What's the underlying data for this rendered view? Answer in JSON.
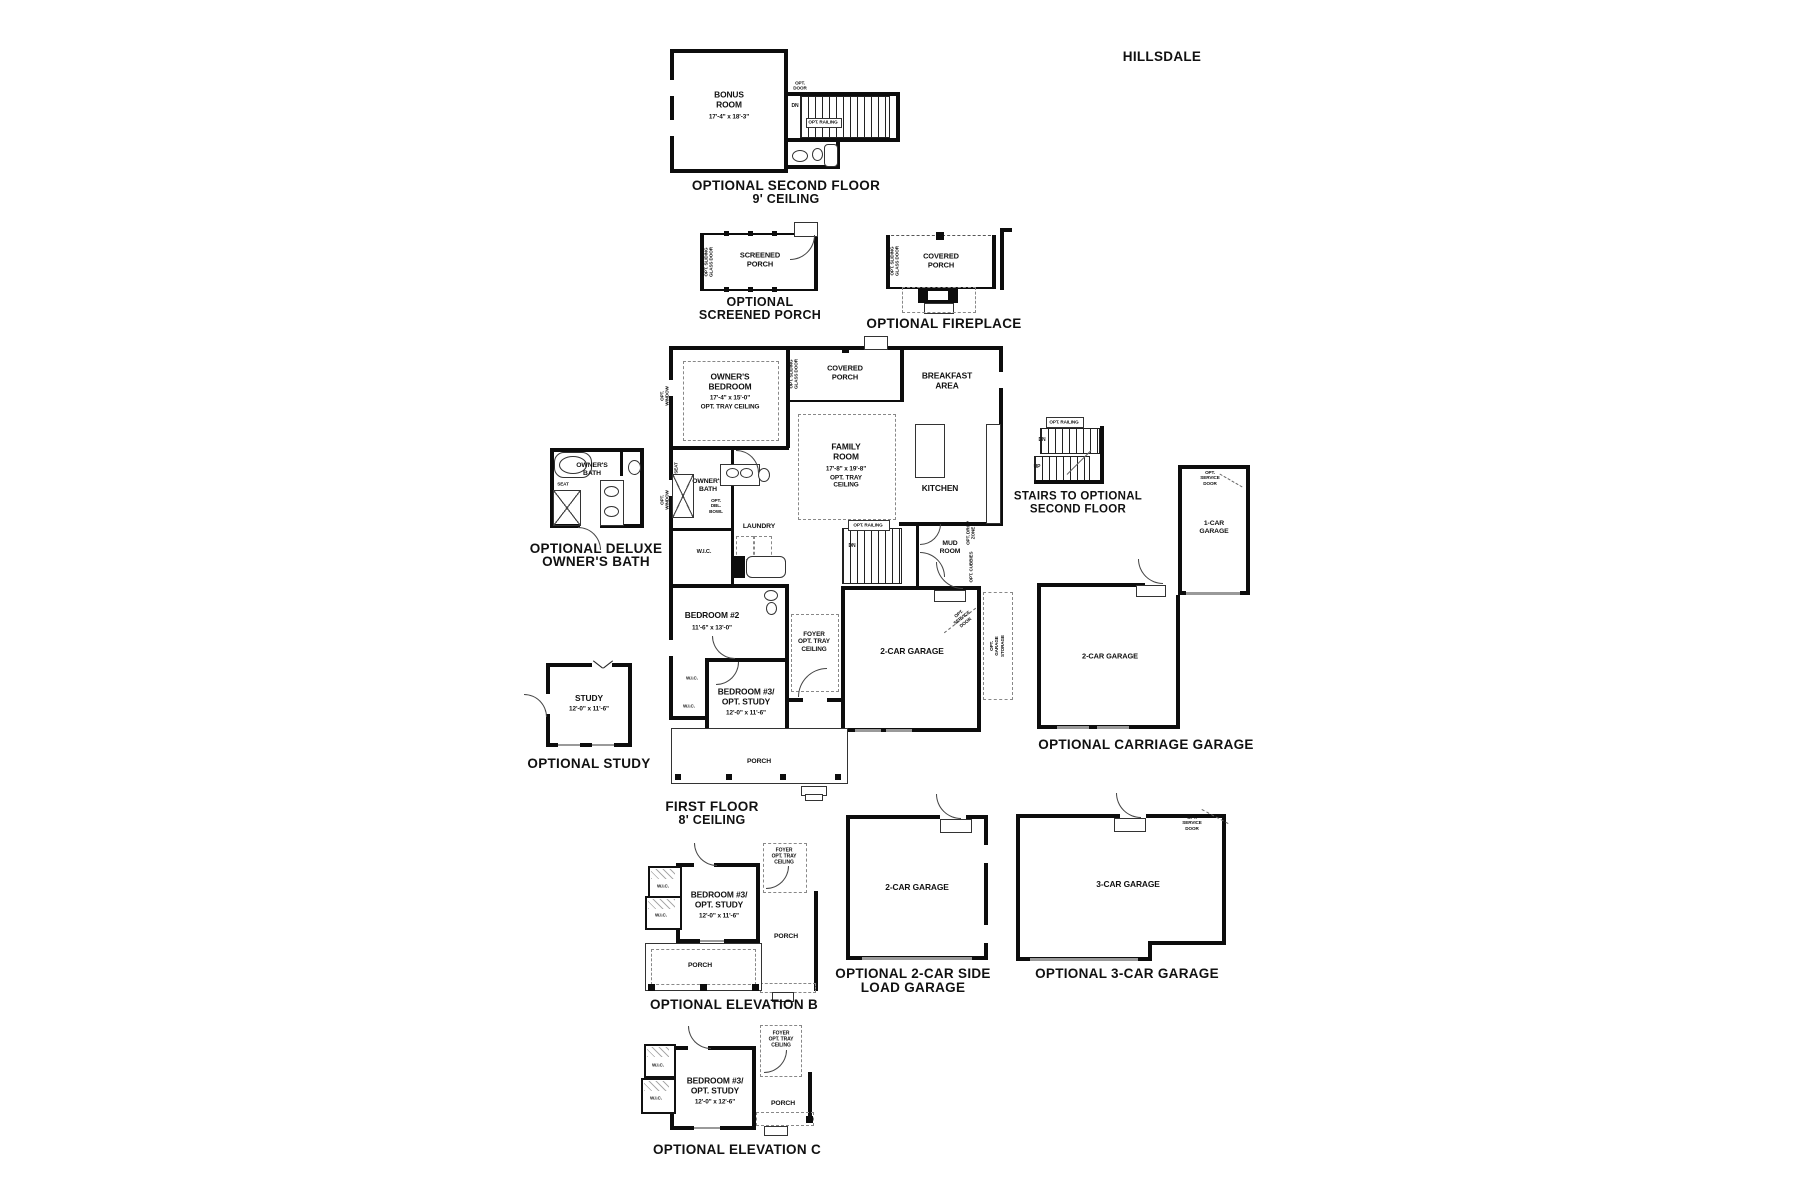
{
  "page": {
    "title": "HILLSDALE"
  },
  "second_floor": {
    "bonus_name": "BONUS\nROOM",
    "bonus_dims": "17'-4\" x 18'-3\"",
    "opt_door": "OPT.\nDOOR",
    "dn": "DN",
    "opt_railing": "OPT. RAILING",
    "caption1": "OPTIONAL SECOND FLOOR",
    "caption2": "9' CEILING"
  },
  "screened_porch": {
    "room": "SCREENED\nPORCH",
    "side_note": "OPT. SLIDING\nGLASS DOOR",
    "caption1": "OPTIONAL",
    "caption2": "SCREENED PORCH"
  },
  "fireplace": {
    "room": "COVERED\nPORCH",
    "side_note": "OPT. SLIDING\nGLASS DOOR",
    "caption": "OPTIONAL FIREPLACE"
  },
  "first_floor": {
    "owners_bedroom_name": "OWNER'S\nBEDROOM",
    "owners_bedroom_dims": "17'-4\" x 15'-0\"",
    "owners_bedroom_note": "OPT. TRAY CEILING",
    "covered_porch": "COVERED\nPORCH",
    "breakfast": "BREAKFAST\nAREA",
    "family_name": "FAMILY\nROOM",
    "family_dims": "17'-8\" x 19'-8\"",
    "family_note": "OPT. TRAY\nCEILING",
    "kitchen": "KITCHEN",
    "owners_bath": "OWNER'S\nBATH",
    "seat": "SEAT",
    "opt_dbl_bowl": "OPT.\nDBL.\nBOWL",
    "laundry": "LAUNDRY",
    "wic": "W.I.C.",
    "mud_room": "MUD\nROOM",
    "opt_drop_zone": "OPT. DROP\nZONE",
    "opt_cubbies": "OPT. CUBBIES",
    "bedroom2_name": "BEDROOM #2",
    "bedroom2_dims": "11'-6\" x 13'-0\"",
    "bedroom3_name": "BEDROOM #3/\nOPT. STUDY",
    "bedroom3_dims": "12'-0\" x 11'-6\"",
    "foyer": "FOYER\nOPT. TRAY\nCEILING",
    "garage": "2-CAR GARAGE",
    "porch": "PORCH",
    "opt_railing": "OPT. RAILING",
    "dn": "DN",
    "opt_window": "OPT.\nWINDOW",
    "opt_sliding": "OPT. SLIDING\nGLASS DOOR",
    "opt_service_door": "OPT.\nSERVICE\nDOOR",
    "opt_garage_storage": "OPT.\nGARAGE\nSTORAGE",
    "caption1": "FIRST FLOOR",
    "caption2": "8' CEILING"
  },
  "deluxe_bath": {
    "room": "OWNER'S\nBATH",
    "seat": "SEAT",
    "caption1": "OPTIONAL DELUXE",
    "caption2": "OWNER'S BATH"
  },
  "opt_stairs": {
    "opt_railing": "OPT. RAILING",
    "dn": "DN",
    "up": "UP",
    "caption1": "STAIRS TO OPTIONAL",
    "caption2": "SECOND FLOOR"
  },
  "carriage": {
    "one_car": "1-CAR\nGARAGE",
    "two_car": "2-CAR GARAGE",
    "opt_service_door": "OPT.\nSERVICE\nDOOR",
    "caption": "OPTIONAL CARRIAGE GARAGE"
  },
  "study": {
    "name": "STUDY",
    "dims": "12'-0\" x 11'-6\"",
    "caption": "OPTIONAL STUDY"
  },
  "elevation_b": {
    "bedroom_name": "BEDROOM #3/\nOPT. STUDY",
    "bedroom_dims": "12'-0\" x 11'-6\"",
    "foyer": "FOYER\nOPT. TRAY\nCEILING",
    "wic": "W.I.C.",
    "porch": "PORCH",
    "caption": "OPTIONAL ELEVATION B"
  },
  "side_load": {
    "room": "2-CAR GARAGE",
    "caption1": "OPTIONAL 2-CAR SIDE",
    "caption2": "LOAD GARAGE"
  },
  "three_car": {
    "room": "3-CAR GARAGE",
    "opt_service_door": "OPT.\nSERVICE\nDOOR",
    "caption": "OPTIONAL 3-CAR GARAGE"
  },
  "elevation_c": {
    "bedroom_name": "BEDROOM #3/\nOPT. STUDY",
    "bedroom_dims": "12'-0\" x 12'-6\"",
    "foyer": "FOYER\nOPT. TRAY\nCEILING",
    "wic": "W.I.C.",
    "porch": "PORCH",
    "caption": "OPTIONAL ELEVATION C"
  }
}
